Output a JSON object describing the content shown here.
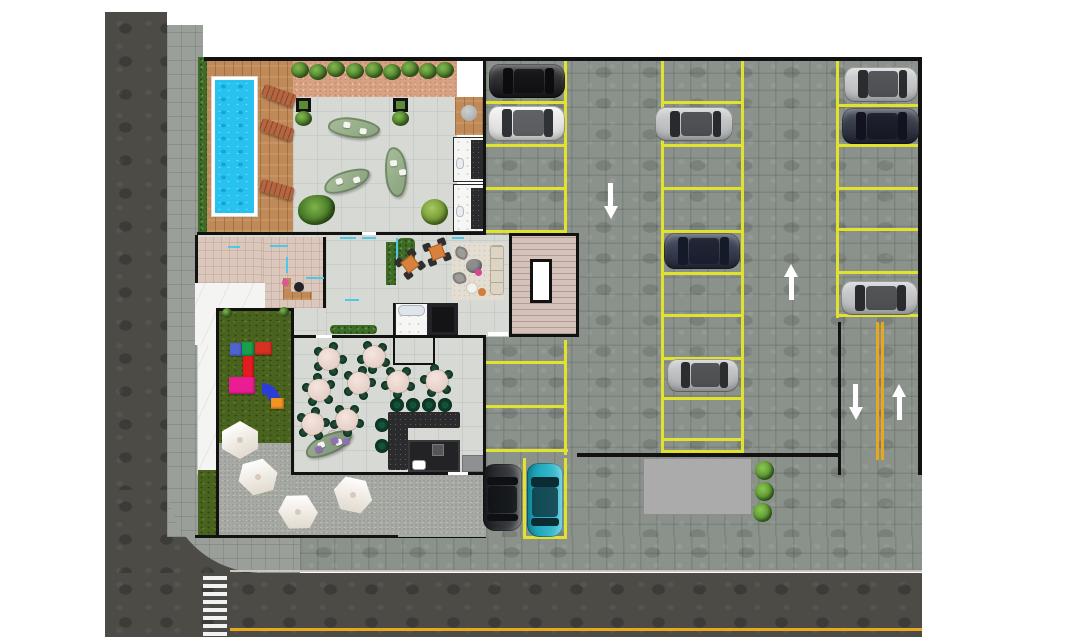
{
  "meta": {
    "kind": "architectural-site-plan",
    "title_visible_text": "",
    "width": 1088,
    "height": 640
  },
  "palette": {
    "background": "#ffffff",
    "road": "#4c4b46",
    "sidewalk": "#9aa099",
    "parking_paver": "#8b928b",
    "stall_yellow": "#e0e22e",
    "road_yellow": "#e7a81e",
    "wall_black": "#121212",
    "pool_blue": "#27c2f0",
    "deck_wood": "#c08a58",
    "grass": "#49631f",
    "gravel_salmon": "#d9a184",
    "terrace_gravel": "#a6aaa3",
    "glass_cyan": "#4fc8e8",
    "loading_pad": "#ababab"
  },
  "areas": [
    {
      "name": "street-left"
    },
    {
      "name": "street-bottom"
    },
    {
      "name": "crosswalk"
    },
    {
      "name": "sidewalk"
    },
    {
      "name": "swimming-pool"
    },
    {
      "name": "pool-deck"
    },
    {
      "name": "amenity-terrace"
    },
    {
      "name": "deck-restrooms"
    },
    {
      "name": "reception-office"
    },
    {
      "name": "lobby-lounge"
    },
    {
      "name": "stair-core"
    },
    {
      "name": "elevator"
    },
    {
      "name": "restaurant"
    },
    {
      "name": "bar-kitchen"
    },
    {
      "name": "back-of-house"
    },
    {
      "name": "playground"
    },
    {
      "name": "outdoor-terrace"
    },
    {
      "name": "parking-lot"
    },
    {
      "name": "two-way-driveway"
    },
    {
      "name": "loading-pad"
    }
  ],
  "site": {
    "walls": [
      [
        204,
        57,
        718,
        4
      ],
      [
        918,
        57,
        4,
        418
      ],
      [
        838,
        322,
        3,
        153
      ],
      [
        577,
        453,
        261,
        4
      ],
      [
        483,
        60,
        3,
        175
      ],
      [
        483,
        337,
        3,
        138
      ],
      [
        197,
        232,
        289,
        3
      ],
      [
        195,
        235,
        3,
        48
      ],
      [
        323,
        237,
        3,
        71
      ],
      [
        216,
        308,
        78,
        3
      ],
      [
        216,
        308,
        3,
        230
      ],
      [
        291,
        308,
        3,
        167
      ],
      [
        294,
        335,
        192,
        3
      ],
      [
        294,
        472,
        192,
        3
      ],
      [
        195,
        535,
        203,
        3
      ],
      [
        393,
        303,
        2,
        62
      ],
      [
        433,
        337,
        2,
        26
      ],
      [
        395,
        363,
        40,
        2
      ]
    ],
    "stall_lines": [
      [
        486,
        101,
        80,
        3
      ],
      [
        486,
        144,
        80,
        3
      ],
      [
        486,
        187,
        80,
        3
      ],
      [
        486,
        230,
        80,
        3
      ],
      [
        564,
        60,
        3,
        173
      ],
      [
        564,
        340,
        3,
        115
      ],
      [
        486,
        361,
        80,
        3
      ],
      [
        486,
        405,
        80,
        3
      ],
      [
        486,
        449,
        82,
        3
      ],
      [
        661,
        58,
        3,
        395
      ],
      [
        741,
        58,
        3,
        395
      ],
      [
        661,
        101,
        83,
        3
      ],
      [
        661,
        144,
        83,
        3
      ],
      [
        661,
        187,
        83,
        3
      ],
      [
        661,
        230,
        83,
        3
      ],
      [
        661,
        272,
        83,
        3
      ],
      [
        661,
        314,
        83,
        3
      ],
      [
        661,
        357,
        83,
        3
      ],
      [
        661,
        397,
        83,
        3
      ],
      [
        661,
        438,
        83,
        3
      ],
      [
        661,
        450,
        83,
        3
      ],
      [
        836,
        60,
        3,
        258
      ],
      [
        836,
        104,
        84,
        3
      ],
      [
        836,
        144,
        84,
        3
      ],
      [
        836,
        187,
        84,
        3
      ],
      [
        836,
        228,
        84,
        3
      ],
      [
        836,
        271,
        84,
        3
      ],
      [
        836,
        314,
        84,
        3
      ],
      [
        523,
        458,
        3,
        80
      ],
      [
        564,
        458,
        3,
        80
      ],
      [
        523,
        536,
        44,
        3
      ]
    ],
    "gold_lines": [
      [
        876,
        322,
        3,
        138
      ],
      [
        881,
        322,
        3,
        138
      ],
      [
        230,
        628,
        692,
        3
      ]
    ],
    "cyan_lines": [
      [
        228,
        246,
        12,
        2
      ],
      [
        270,
        245,
        18,
        2
      ],
      [
        286,
        257,
        2,
        16
      ],
      [
        306,
        277,
        18,
        2
      ],
      [
        340,
        237,
        16,
        2
      ],
      [
        362,
        237,
        14,
        2
      ],
      [
        396,
        238,
        2,
        20
      ],
      [
        345,
        299,
        14,
        2
      ],
      [
        452,
        237,
        12,
        2
      ]
    ],
    "doors": [
      [
        316,
        335,
        16,
        3
      ],
      [
        448,
        472,
        20,
        3
      ],
      [
        362,
        232,
        14,
        3
      ],
      [
        488,
        332,
        20,
        4
      ]
    ],
    "vehicles": [
      {
        "name": "black-sedan",
        "cx": 527,
        "cy": 81,
        "len": 76,
        "wid": 34,
        "rot": 0,
        "body": "#191a1e",
        "glass": "#0c0c0e"
      },
      {
        "name": "white-suv",
        "cx": 526,
        "cy": 123,
        "len": 77,
        "wid": 35,
        "rot": 0,
        "body": "#f3f3f2",
        "glass": "#2f3236"
      },
      {
        "name": "silver-sedan",
        "cx": 694,
        "cy": 124,
        "len": 78,
        "wid": 34,
        "rot": 0,
        "body": "#c7c9ca",
        "glass": "#282a2d"
      },
      {
        "name": "navy-suv",
        "cx": 702,
        "cy": 251,
        "len": 76,
        "wid": 36,
        "rot": 0,
        "body": "#272e42",
        "glass": "#151a28"
      },
      {
        "name": "silver-sedan",
        "cx": 703,
        "cy": 375,
        "len": 72,
        "wid": 33,
        "rot": 0,
        "body": "#c3c5c6",
        "glass": "#2b2d30"
      },
      {
        "name": "silver-sedan",
        "cx": 881,
        "cy": 84,
        "len": 74,
        "wid": 35,
        "rot": 0,
        "body": "#cccecf",
        "glass": "#2a2c2f"
      },
      {
        "name": "navy-suv",
        "cx": 880,
        "cy": 126,
        "len": 77,
        "wid": 36,
        "rot": 0,
        "body": "#232938",
        "glass": "#11141f"
      },
      {
        "name": "silver-sedan",
        "cx": 879,
        "cy": 298,
        "len": 77,
        "wid": 34,
        "rot": 0,
        "body": "#c9cbcd",
        "glass": "#292b2e"
      },
      {
        "name": "black-suv",
        "cx": 502,
        "cy": 497,
        "len": 67,
        "wid": 39,
        "rot": 90,
        "body": "#1e2127",
        "glass": "#0e1013"
      },
      {
        "name": "teal-sedan",
        "cx": 545,
        "cy": 500,
        "len": 74,
        "wid": 36,
        "rot": 90,
        "body": "#17b5cd",
        "glass": "#0d2b33"
      }
    ],
    "arrows": [
      {
        "cx": 611,
        "cy": 200,
        "dir": "down"
      },
      {
        "cx": 791,
        "cy": 283,
        "dir": "up"
      },
      {
        "cx": 856,
        "cy": 401,
        "dir": "down"
      },
      {
        "cx": 899,
        "cy": 403,
        "dir": "up"
      }
    ],
    "restaurant_tables": [
      [
        329,
        359
      ],
      [
        374,
        357
      ],
      [
        319,
        390
      ],
      [
        359,
        383
      ],
      [
        398,
        382
      ],
      [
        437,
        381
      ],
      [
        313,
        424
      ],
      [
        347,
        420
      ]
    ],
    "lobby_tables": [
      [
        410,
        264
      ],
      [
        437,
        252
      ]
    ],
    "bar_stools": [
      [
        397,
        405
      ],
      [
        413,
        405
      ],
      [
        429,
        405
      ],
      [
        445,
        405
      ],
      [
        382,
        425
      ],
      [
        382,
        446
      ]
    ],
    "umbrellas": [
      [
        240,
        440
      ],
      [
        258,
        477
      ],
      [
        298,
        512
      ],
      [
        353,
        495
      ]
    ],
    "pad_bushes": [
      [
        764,
        470
      ],
      [
        764,
        491
      ],
      [
        762,
        512
      ]
    ],
    "hedge_bushes": [
      [
        300,
        70
      ],
      [
        318,
        72
      ],
      [
        336,
        69
      ],
      [
        355,
        71
      ],
      [
        374,
        70
      ],
      [
        392,
        72
      ],
      [
        410,
        69
      ],
      [
        428,
        71
      ],
      [
        445,
        70
      ]
    ],
    "grass_bushes": [
      [
        227,
        313
      ],
      [
        284,
        312
      ]
    ],
    "loungers": [
      {
        "cx": 279,
        "cy": 96,
        "rot": 20
      },
      {
        "cx": 277,
        "cy": 130,
        "rot": 20
      },
      {
        "cx": 277,
        "cy": 190,
        "rot": 16
      }
    ],
    "benches": [
      {
        "cx": 354,
        "cy": 128,
        "w": 52,
        "h": 20,
        "rot": 8
      },
      {
        "cx": 396,
        "cy": 172,
        "w": 22,
        "h": 50,
        "rot": -6
      },
      {
        "cx": 347,
        "cy": 181,
        "w": 48,
        "h": 20,
        "rot": -18
      },
      {
        "cx": 329,
        "cy": 444,
        "w": 50,
        "h": 20,
        "rot": -22
      }
    ],
    "planters": [
      [
        296,
        98
      ],
      [
        393,
        98
      ]
    ],
    "playground_pieces": [
      {
        "x": 230,
        "y": 343,
        "w": 12,
        "h": 13,
        "c": "#5064d0"
      },
      {
        "x": 242,
        "y": 342,
        "w": 12,
        "h": 14,
        "c": "#18a04b"
      },
      {
        "x": 255,
        "y": 342,
        "w": 17,
        "h": 13,
        "c": "#d63222"
      },
      {
        "x": 243,
        "y": 356,
        "w": 11,
        "h": 23,
        "c": "#e41b1f"
      },
      {
        "x": 229,
        "y": 377,
        "w": 26,
        "h": 17,
        "c": "#eb1d93"
      },
      {
        "x": 271,
        "y": 398,
        "w": 13,
        "h": 11,
        "c": "#f29420"
      }
    ],
    "crosswalk": {
      "stripes": 10
    }
  }
}
